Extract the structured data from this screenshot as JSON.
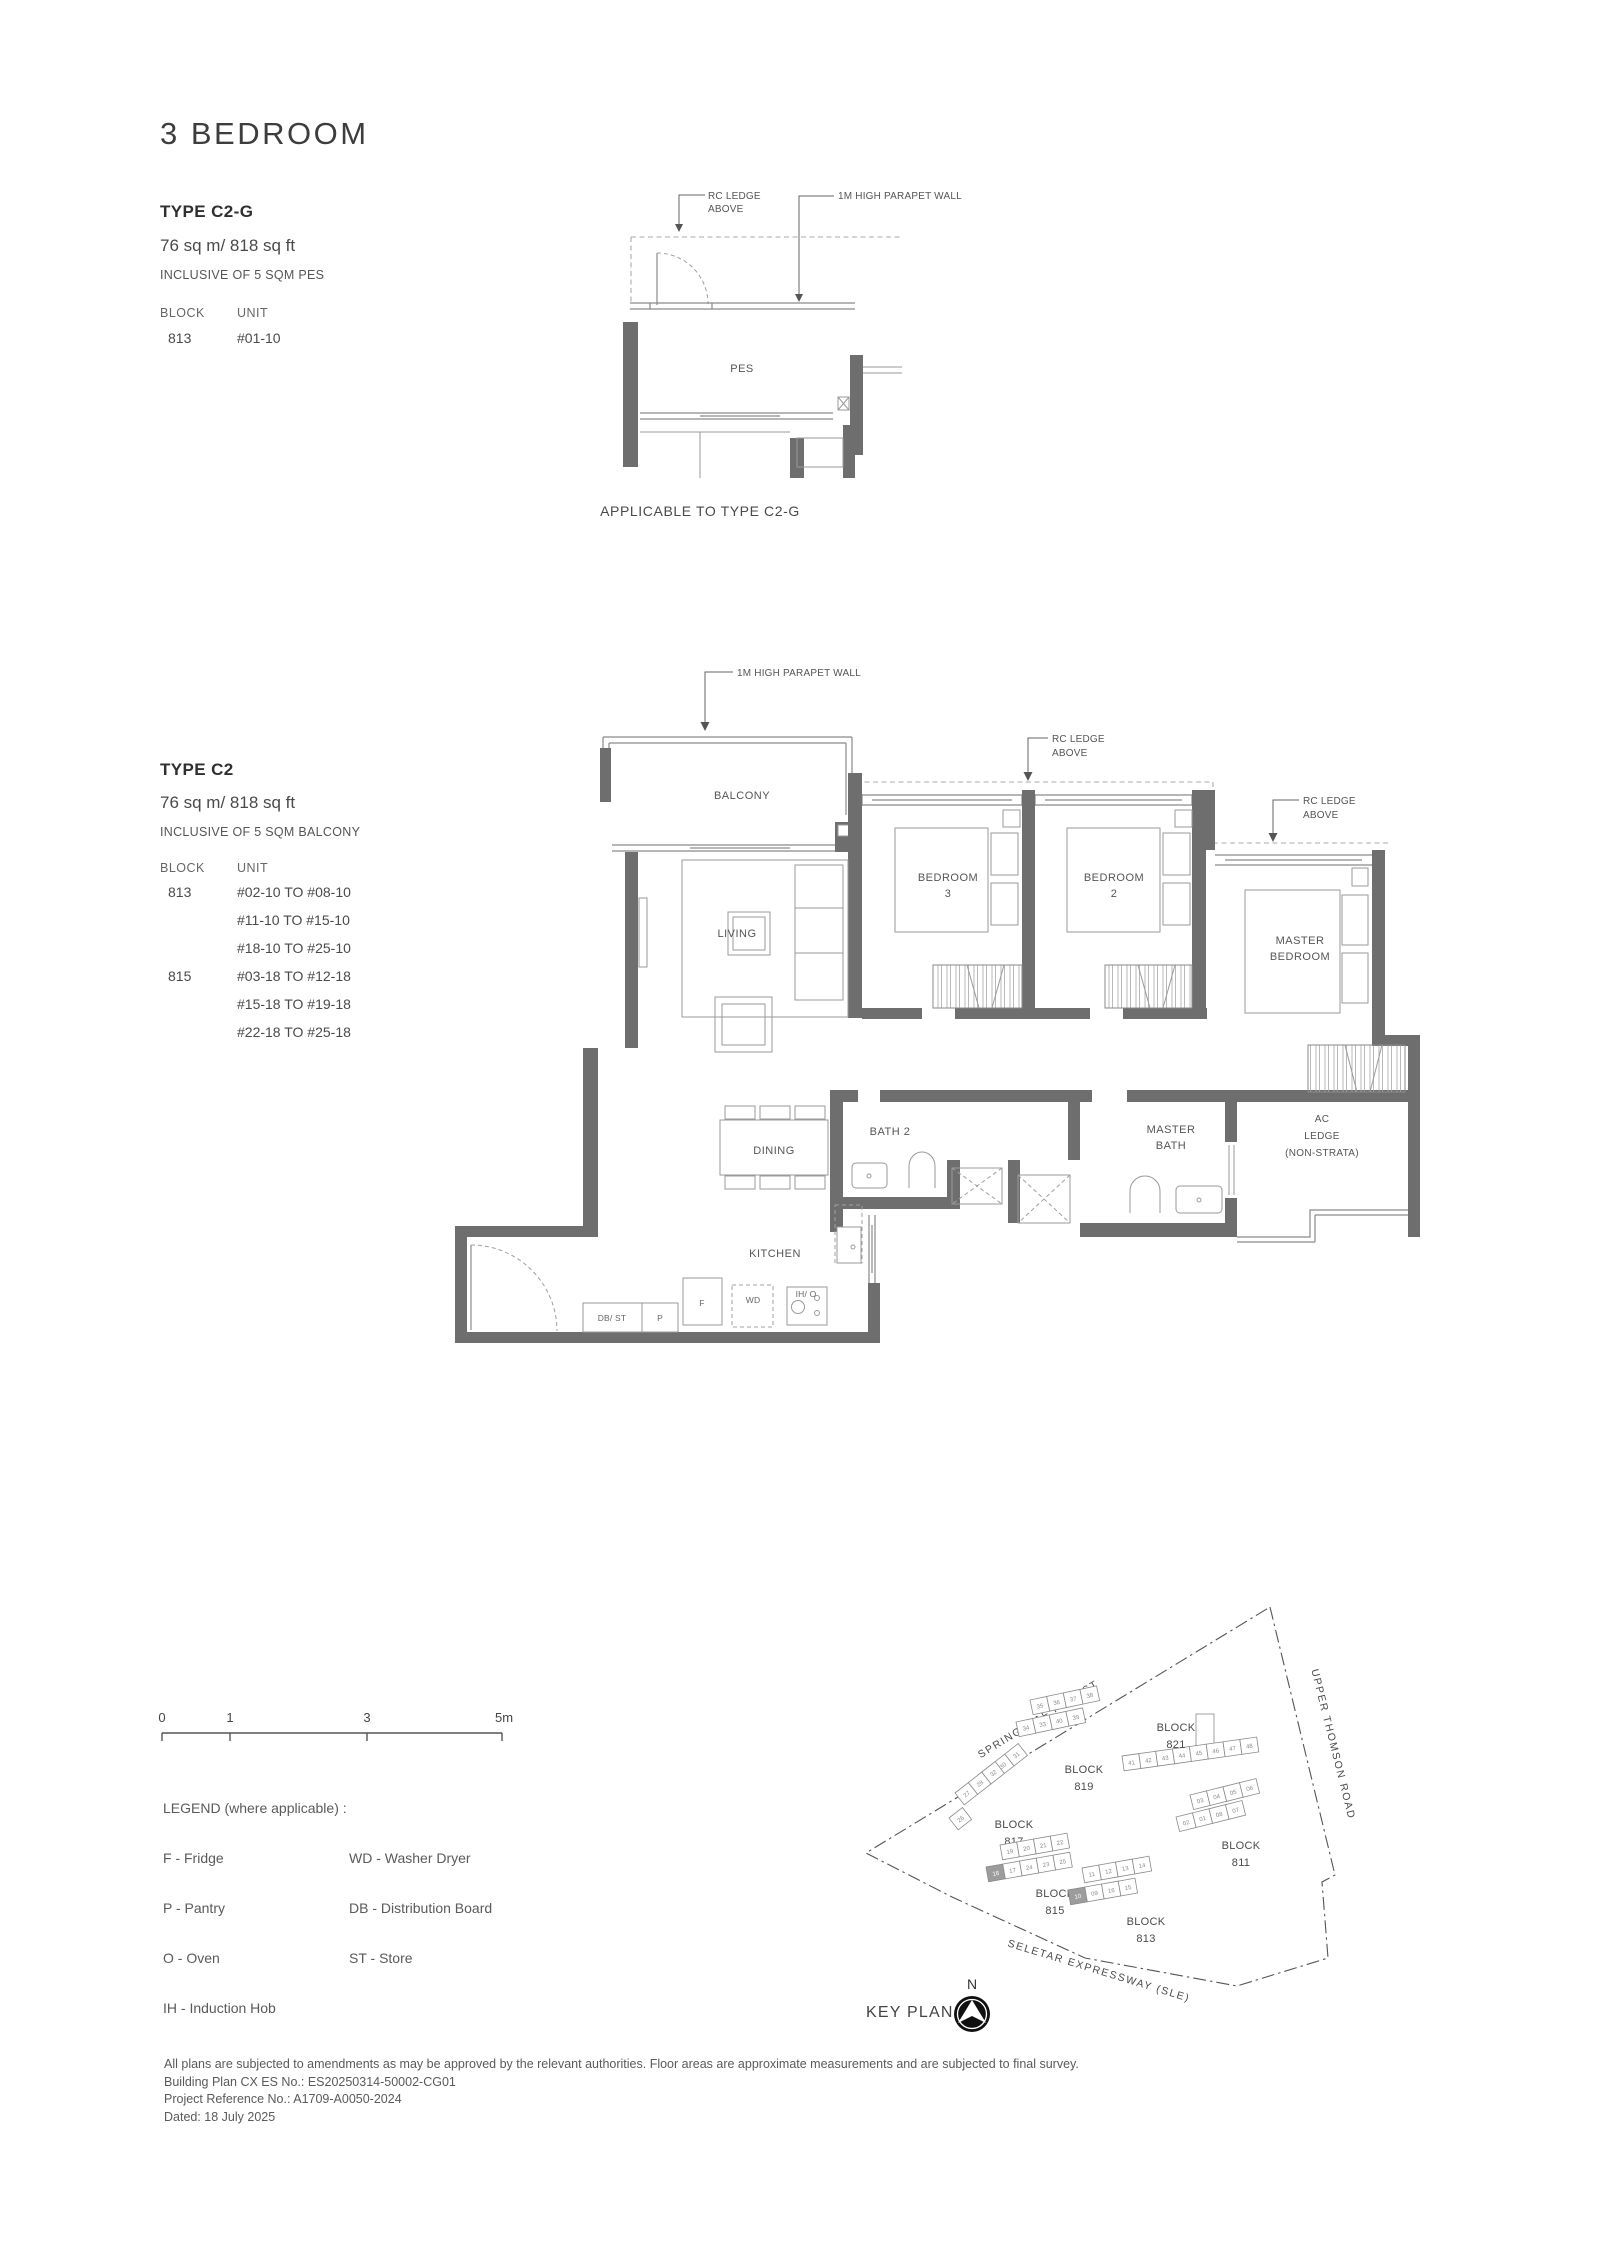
{
  "header": {
    "title": "3 BEDROOM"
  },
  "type_c2g": {
    "name": "TYPE C2-G",
    "area": "76 sq m/ 818 sq ft",
    "inclusive": "INCLUSIVE OF 5 SQM PES",
    "block_header": "BLOCK",
    "unit_header": "UNIT",
    "block": "813",
    "unit": "#01-10",
    "caption": "APPLICABLE TO TYPE C2-G"
  },
  "small_plan": {
    "rc_ledge": [
      "RC LEDGE",
      "ABOVE"
    ],
    "parapet": "1M HIGH PARAPET WALL",
    "pes": "PES"
  },
  "type_c2": {
    "name": "TYPE C2",
    "area": "76 sq m/ 818 sq ft",
    "inclusive": "INCLUSIVE OF 5 SQM BALCONY",
    "block_header": "BLOCK",
    "unit_header": "UNIT",
    "rows": [
      {
        "block": "813",
        "units": [
          "#02-10 TO #08-10",
          "#11-10 TO #15-10",
          "#18-10 TO #25-10"
        ]
      },
      {
        "block": "815",
        "units": [
          "#03-18 TO #12-18",
          "#15-18 TO #19-18",
          "#22-18 TO #25-18"
        ]
      }
    ]
  },
  "floorplan": {
    "parapet": "1M HIGH PARAPET WALL",
    "rc_ledge_1": [
      "RC LEDGE",
      "ABOVE"
    ],
    "rc_ledge_2": [
      "RC LEDGE",
      "ABOVE"
    ],
    "balcony": "BALCONY",
    "living": "LIVING",
    "bedroom3": [
      "BEDROOM",
      "3"
    ],
    "bedroom2": [
      "BEDROOM",
      "2"
    ],
    "master_bedroom": [
      "MASTER",
      "BEDROOM"
    ],
    "dining": "DINING",
    "bath2": "BATH 2",
    "master_bath": [
      "MASTER",
      "BATH"
    ],
    "ac_ledge": [
      "AC",
      "LEDGE",
      "(NON-STRATA)"
    ],
    "kitchen": "KITCHEN",
    "appliances": {
      "dbst": "DB/ ST",
      "p": "P",
      "f": "F",
      "wd": "WD",
      "iho": "IH/ O"
    }
  },
  "scale_bar": {
    "ticks": [
      "0",
      "1",
      "3",
      "5m"
    ]
  },
  "legend": {
    "title": "LEGEND (where applicable) :",
    "left": [
      "F - Fridge",
      "P - Pantry",
      "O - Oven",
      "IH - Induction Hob"
    ],
    "right": [
      "WD - Washer Dryer",
      "DB - Distribution Board",
      "ST - Store"
    ]
  },
  "keyplan": {
    "title": "KEY PLAN",
    "north": "N",
    "roads": {
      "springleaf": "SPRINGLEAF FOREST",
      "thomson": "UPPER THOMSON ROAD",
      "seletar": "SELETAR EXPRESSWAY (SLE)"
    },
    "blocks": [
      {
        "label": [
          "BLOCK",
          "821"
        ],
        "rows": [
          [
            "41",
            "42",
            "43",
            "44",
            "45",
            "46",
            "47",
            "48"
          ]
        ],
        "highlight": ""
      },
      {
        "label": [
          "BLOCK",
          "819"
        ],
        "rows": [
          [
            "35",
            "36",
            "37",
            "38"
          ],
          [
            "34",
            "33",
            "40",
            "39"
          ]
        ],
        "highlight": ""
      },
      {
        "label": [
          "BLOCK",
          "817"
        ],
        "rows": [
          [
            "29",
            "30",
            "31"
          ],
          [
            "27",
            "28",
            "32"
          ],
          [
            "26"
          ]
        ],
        "highlight": ""
      },
      {
        "label": [
          "BLOCK",
          "815"
        ],
        "rows": [
          [
            "19",
            "20",
            "21",
            "22"
          ],
          [
            "18",
            "17",
            "24",
            "23",
            "25"
          ]
        ],
        "highlight": "18"
      },
      {
        "label": [
          "BLOCK",
          "813"
        ],
        "rows": [
          [
            "11",
            "12",
            "13",
            "14"
          ],
          [
            "10",
            "09",
            "16",
            "15"
          ]
        ],
        "highlight": "10"
      },
      {
        "label": [
          "BLOCK",
          "811"
        ],
        "rows": [
          [
            "03",
            "04",
            "05",
            "06"
          ],
          [
            "02",
            "01",
            "08",
            "07"
          ]
        ],
        "highlight": ""
      }
    ]
  },
  "footer": {
    "line1": "All plans are subjected to amendments as may be approved by the relevant authorities. Floor areas are approximate measurements and are subjected to final survey.",
    "line2": "Building Plan CX ES No.: ES20250314-50002-CG01",
    "line3": "Project Reference No.: A1709-A0050-2024",
    "line4": "Dated: 18 July 2025"
  }
}
